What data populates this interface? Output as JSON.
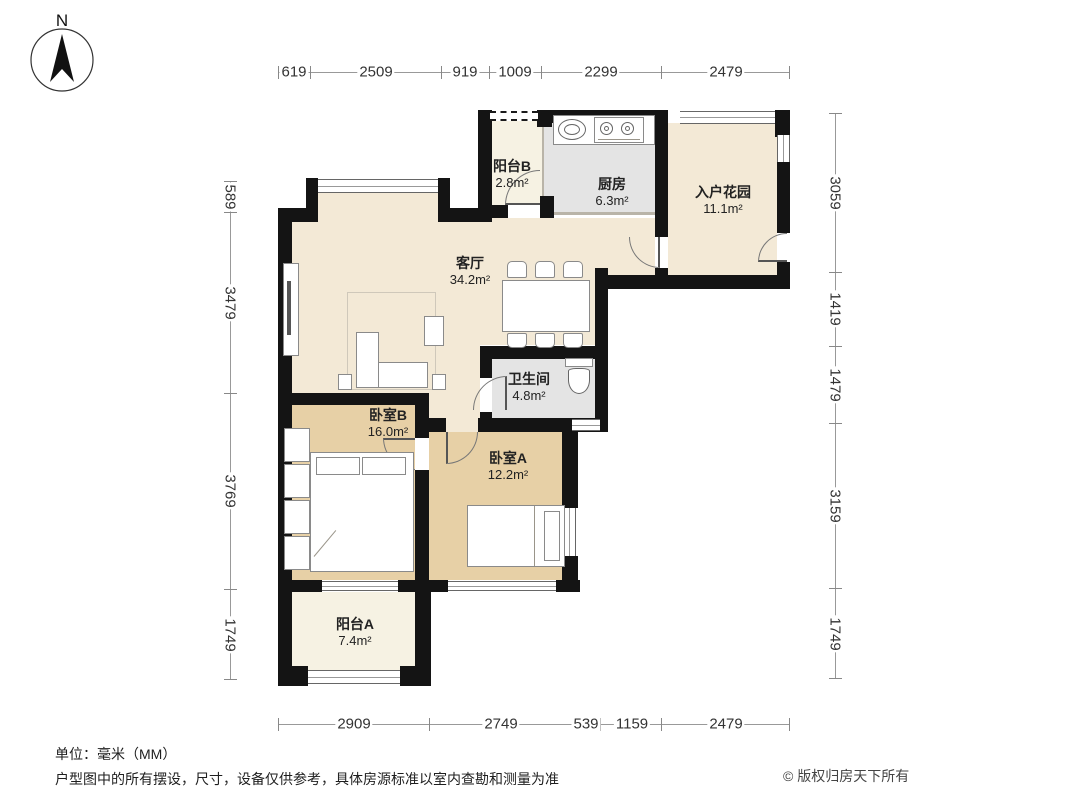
{
  "compass": {
    "label": "N"
  },
  "rooms": [
    {
      "id": "balcony-b",
      "name": "阳台B",
      "area": "2.8m²"
    },
    {
      "id": "kitchen",
      "name": "厨房",
      "area": "6.3m²"
    },
    {
      "id": "entry-garden",
      "name": "入户花园",
      "area": "11.1m²"
    },
    {
      "id": "living-room",
      "name": "客厅",
      "area": "34.2m²"
    },
    {
      "id": "bathroom",
      "name": "卫生间",
      "area": "4.8m²"
    },
    {
      "id": "bedroom-b",
      "name": "卧室B",
      "area": "16.0m²"
    },
    {
      "id": "bedroom-a",
      "name": "卧室A",
      "area": "12.2m²"
    },
    {
      "id": "balcony-a",
      "name": "阳台A",
      "area": "7.4m²"
    }
  ],
  "dimensions": {
    "top": [
      "619",
      "2509",
      "919",
      "1009",
      "2299",
      "2479"
    ],
    "bottom": [
      "2909",
      "2749",
      "539",
      "1159",
      "2479"
    ],
    "left": [
      "589",
      "3479",
      "3769",
      "1749"
    ],
    "right": [
      "3059",
      "1419",
      "1479",
      "3159",
      "1749"
    ]
  },
  "footer": {
    "unit_note": "单位：毫米（MM）",
    "disclaimer": "户型图中的所有摆设，尺寸，设备仅供参考，具体房源标准以室内查勘和测量为准",
    "copyright": "© 版权归房天下所有"
  },
  "colors": {
    "wall": "#141414",
    "floor_living": "#f3e9d6",
    "floor_bedroom": "#e7d0a6",
    "floor_wet": "#e4e4e4",
    "floor_balcony": "#f6f2e3",
    "dim_text": "#333333",
    "label_text": "#222222"
  }
}
